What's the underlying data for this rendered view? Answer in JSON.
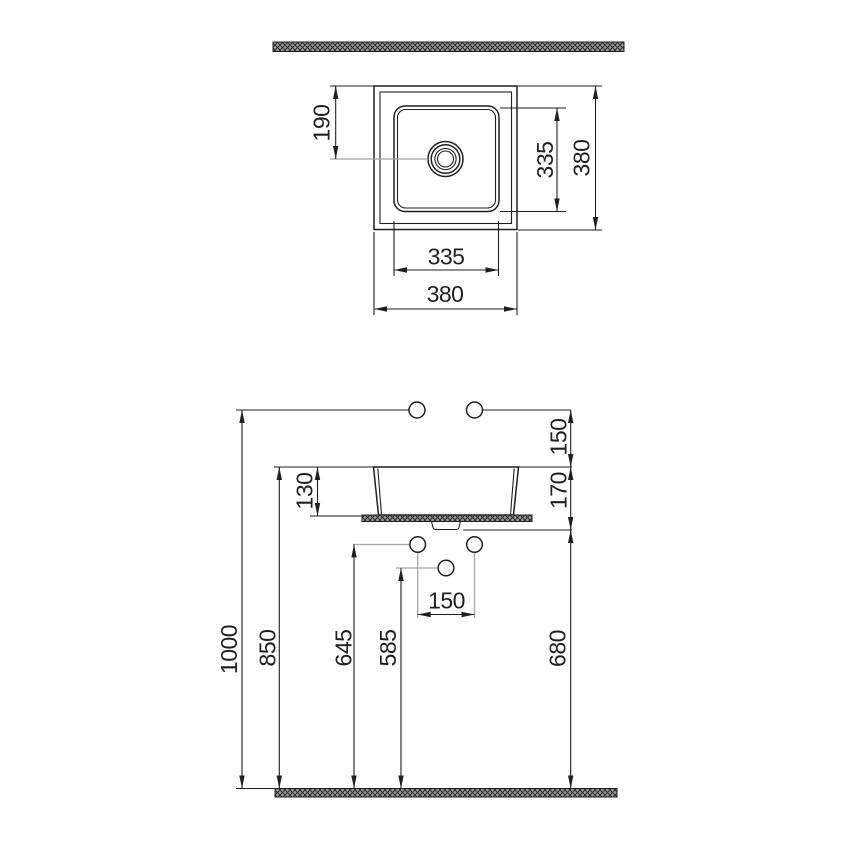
{
  "plan": {
    "dim_drain_offset_from_edge": "190",
    "dim_basin_vertical": "335",
    "dim_overall_depth": "380",
    "dim_basin_horizontal": "335",
    "dim_overall_width": "380"
  },
  "elevation": {
    "dim_supply_line_height": "1000",
    "dim_rim_height": "850",
    "dim_bowl_depth": "130",
    "dim_left_connection_height": "645",
    "dim_drain_connection_height": "585",
    "dim_supply_above_rim": "150",
    "dim_rim_to_counter_underside": "170",
    "dim_counter_underside_height": "680",
    "dim_connection_spacing": "150"
  },
  "colors": {
    "line": "#1f1f1f",
    "leader_gray": "#a5a5a5",
    "hatch_background": "#9c9c9c",
    "hatch_lines": "#2d2d2d",
    "background": "#ffffff"
  }
}
